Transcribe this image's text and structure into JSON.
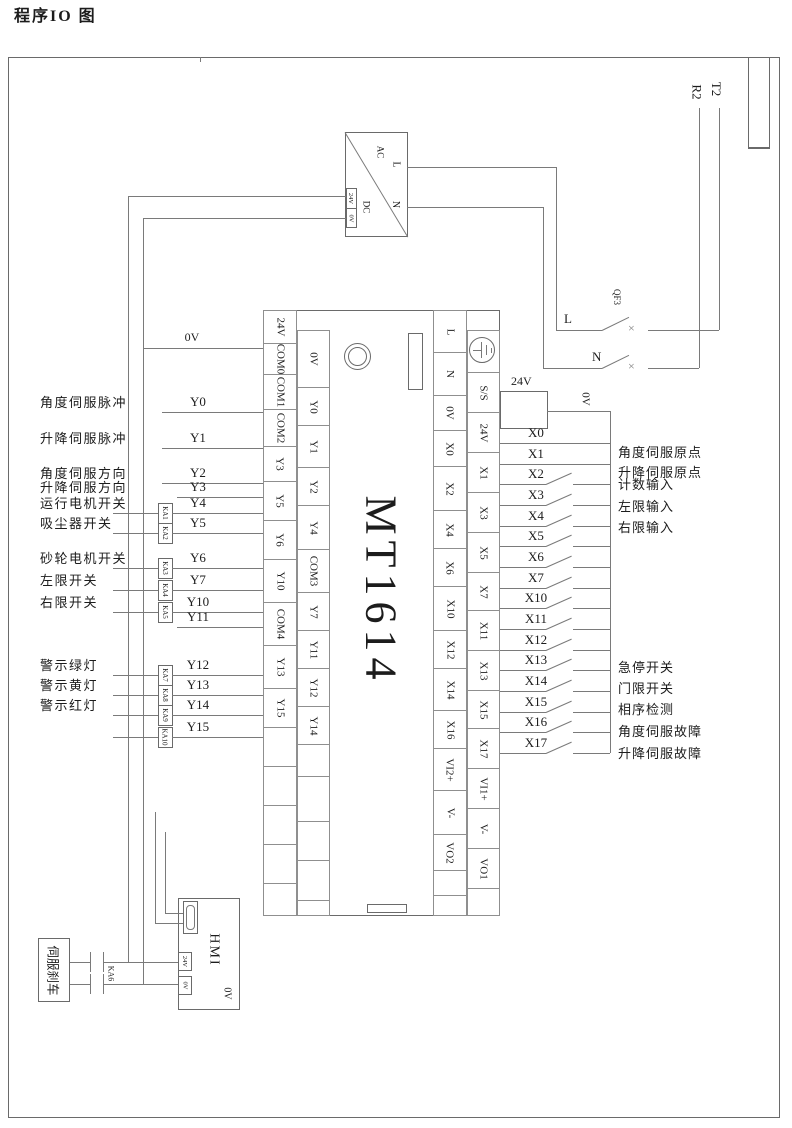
{
  "title": {
    "text": "程序IO 图"
  },
  "mains": {
    "t2": "T2",
    "r2": "R2"
  },
  "power_supply": {
    "ac": "AC",
    "dc": "DC",
    "l": "L",
    "n": "N",
    "out24": "24V",
    "out0": "0V"
  },
  "breaker": {
    "name": "QF3",
    "l": "L",
    "n": "N",
    "cross": "×"
  },
  "plc": {
    "model": "MT1614",
    "left_outer": [
      {
        "t": "24V",
        "h": 34
      },
      {
        "t": "COM0",
        "h": 32
      },
      {
        "t": "COM1",
        "h": 36
      },
      {
        "t": "COM2",
        "h": 38
      },
      {
        "t": "Y3",
        "h": 36
      },
      {
        "t": "Y5",
        "h": 40
      },
      {
        "t": "Y6",
        "h": 40
      },
      {
        "t": "Y10",
        "h": 44
      },
      {
        "t": "COM4",
        "h": 44
      },
      {
        "t": "Y13",
        "h": 44
      },
      {
        "t": "Y15",
        "h": 40
      },
      {
        "t": "",
        "h": 40
      },
      {
        "t": "",
        "h": 40
      },
      {
        "t": "",
        "h": 40
      },
      {
        "t": "",
        "h": 40
      },
      {
        "t": "",
        "h": 33
      }
    ],
    "left_inner": [
      {
        "t": "0V",
        "h": 58
      },
      {
        "t": "Y0",
        "h": 39
      },
      {
        "t": "Y1",
        "h": 43
      },
      {
        "t": "Y2",
        "h": 39
      },
      {
        "t": "Y4",
        "h": 45
      },
      {
        "t": "COM3",
        "h": 44
      },
      {
        "t": "Y7",
        "h": 39
      },
      {
        "t": "Y11",
        "h": 39
      },
      {
        "t": "Y12",
        "h": 39
      },
      {
        "t": "Y14",
        "h": 39
      },
      {
        "t": "",
        "h": 33
      },
      {
        "t": "",
        "h": 46
      },
      {
        "t": "",
        "h": 40
      },
      {
        "t": "",
        "h": 41
      },
      {
        "t": "",
        "h": 16
      }
    ],
    "right_inner": [
      {
        "t": "L",
        "h": 43
      },
      {
        "t": "N",
        "h": 44
      },
      {
        "t": "0V",
        "h": 36
      },
      {
        "t": "X0",
        "h": 37
      },
      {
        "t": "X2",
        "h": 45
      },
      {
        "t": "X4",
        "h": 39
      },
      {
        "t": "X6",
        "h": 39
      },
      {
        "t": "X10",
        "h": 45
      },
      {
        "t": "X12",
        "h": 39
      },
      {
        "t": "X14",
        "h": 43
      },
      {
        "t": "X16",
        "h": 39
      },
      {
        "t": "VI2+",
        "h": 43
      },
      {
        "t": "V-",
        "h": 45
      },
      {
        "t": "VO2",
        "h": 37
      },
      {
        "t": "",
        "h": 26
      },
      {
        "t": "",
        "h": 21
      }
    ],
    "right_outer": [
      {
        "t": "",
        "h": 43,
        "gnd": true
      },
      {
        "t": "S/S",
        "h": 41
      },
      {
        "t": "24V",
        "h": 41
      },
      {
        "t": "X1",
        "h": 41
      },
      {
        "t": "X3",
        "h": 41
      },
      {
        "t": "X5",
        "h": 41
      },
      {
        "t": "X7",
        "h": 39
      },
      {
        "t": "X11",
        "h": 41
      },
      {
        "t": "X13",
        "h": 41
      },
      {
        "t": "X15",
        "h": 39
      },
      {
        "t": "X17",
        "h": 41
      },
      {
        "t": "VI1+",
        "h": 41
      },
      {
        "t": "V-",
        "h": 41
      },
      {
        "t": "VO1",
        "h": 41
      },
      {
        "t": "",
        "h": 28
      }
    ]
  },
  "outputs": {
    "rail0v_label": "0V",
    "rows": [
      {
        "wire": "0V",
        "y": 348,
        "x1": 143,
        "label": "",
        "relay": ""
      },
      {
        "wire": "Y0",
        "y": 412,
        "x1": 162,
        "label": "角度伺服脉冲",
        "relay": ""
      },
      {
        "wire": "Y1",
        "y": 448,
        "x1": 162,
        "label": "升降伺服脉冲",
        "relay": ""
      },
      {
        "wire": "Y2",
        "y": 483,
        "x1": 162,
        "label": "角度伺服方向",
        "relay": ""
      },
      {
        "wire": "Y3",
        "y": 497,
        "x1": 177,
        "label": "升降伺服方向",
        "relay": ""
      },
      {
        "wire": "Y4",
        "y": 513,
        "x1": 113,
        "label": "运行电机开关",
        "relay": "KA1"
      },
      {
        "wire": "Y5",
        "y": 533,
        "x1": 113,
        "label": "吸尘器开关",
        "relay": "KA2"
      },
      {
        "wire": "Y6",
        "y": 568,
        "x1": 113,
        "label": "砂轮电机开关",
        "relay": "KA3"
      },
      {
        "wire": "Y7",
        "y": 590,
        "x1": 113,
        "label": "左限开关",
        "relay": "KA4"
      },
      {
        "wire": "Y10",
        "y": 612,
        "x1": 113,
        "label": "右限开关",
        "relay": "KA5"
      },
      {
        "wire": "Y11",
        "y": 627,
        "x1": 177,
        "label": "",
        "relay": ""
      },
      {
        "wire": "Y12",
        "y": 675,
        "x1": 113,
        "label": "警示绿灯",
        "relay": "KA7"
      },
      {
        "wire": "Y13",
        "y": 695,
        "x1": 113,
        "label": "警示黄灯",
        "relay": "KA8"
      },
      {
        "wire": "Y14",
        "y": 715,
        "x1": 113,
        "label": "警示红灯",
        "relay": "KA9"
      },
      {
        "wire": "Y15",
        "y": 737,
        "x1": 113,
        "label": "",
        "relay": "KA10"
      }
    ]
  },
  "inputs": {
    "v24_label": "24V",
    "v0_label": "0V",
    "rows": [
      {
        "wire": "X0",
        "y": 443,
        "sw": false,
        "label": "角度伺服原点",
        "ly": 446
      },
      {
        "wire": "X1",
        "y": 464,
        "sw": false,
        "label": "升降伺服原点",
        "ly": 466
      },
      {
        "wire": "X2",
        "y": 484,
        "sw": true,
        "label": "计数输入",
        "ly": 478
      },
      {
        "wire": "X3",
        "y": 505,
        "sw": true,
        "label": "左限输入",
        "ly": 500
      },
      {
        "wire": "X4",
        "y": 526,
        "sw": true,
        "label": "右限输入",
        "ly": 521
      },
      {
        "wire": "X5",
        "y": 546,
        "sw": true,
        "label": "",
        "ly": 0
      },
      {
        "wire": "X6",
        "y": 567,
        "sw": true,
        "label": "",
        "ly": 0
      },
      {
        "wire": "X7",
        "y": 588,
        "sw": true,
        "label": "",
        "ly": 0
      },
      {
        "wire": "X10",
        "y": 608,
        "sw": true,
        "label": "",
        "ly": 0
      },
      {
        "wire": "X11",
        "y": 629,
        "sw": true,
        "label": "",
        "ly": 0
      },
      {
        "wire": "X12",
        "y": 650,
        "sw": true,
        "label": "",
        "ly": 0
      },
      {
        "wire": "X13",
        "y": 670,
        "sw": true,
        "label": "急停开关",
        "ly": 661
      },
      {
        "wire": "X14",
        "y": 691,
        "sw": true,
        "label": "门限开关",
        "ly": 682
      },
      {
        "wire": "X15",
        "y": 712,
        "sw": true,
        "label": "相序检测",
        "ly": 703
      },
      {
        "wire": "X16",
        "y": 732,
        "sw": true,
        "label": "角度伺服故障",
        "ly": 725
      },
      {
        "wire": "X17",
        "y": 753,
        "sw": true,
        "label": "升降伺服故障",
        "ly": 747
      }
    ]
  },
  "hmi": {
    "name": "HMI",
    "t24": "24V",
    "t0": "0V",
    "corner0": "0V"
  },
  "brake": {
    "name": "伺服刹车",
    "relay": "KA6"
  },
  "colors": {
    "wire": "#7a7a7a",
    "box_border": "#6a6a6a",
    "cell_border": "#8f8f8f",
    "text": "#1c1c1c"
  }
}
